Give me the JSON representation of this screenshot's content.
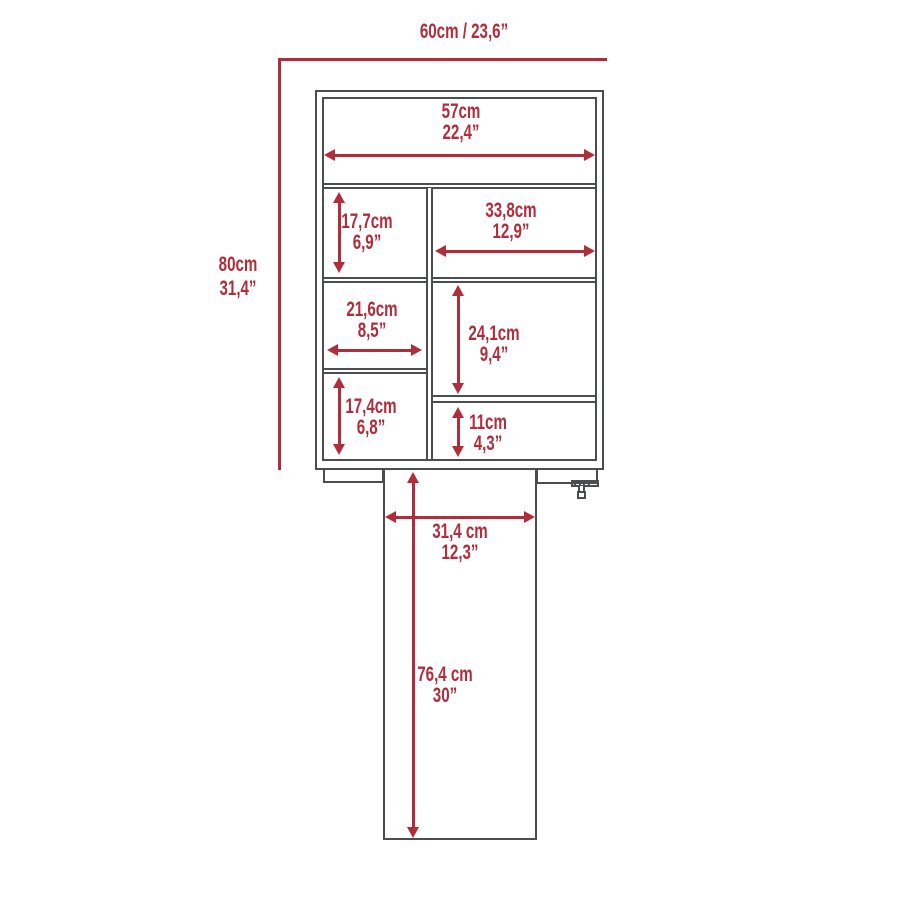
{
  "meta": {
    "diagram_type": "furniture-dimension-diagram",
    "background_color": "#ffffff",
    "accent_color": "#b22d3c",
    "line_color": "#4c4d4f"
  },
  "dimensions": {
    "overall_width": {
      "combined": "60cm / 23,6”"
    },
    "overall_height": {
      "cm": "80cm",
      "in": "31,4”"
    },
    "inner_width": {
      "cm": "57cm",
      "in": "22,4”"
    },
    "upper_left_height": {
      "cm": "17,7cm",
      "in": "6,9”"
    },
    "upper_right_width": {
      "cm": "33,8cm",
      "in": "12,9”"
    },
    "middle_left_width": {
      "cm": "21,6cm",
      "in": "8,5”"
    },
    "middle_right_height": {
      "cm": "24,1cm",
      "in": "9,4”"
    },
    "lower_left_height": {
      "cm": "17,4cm",
      "in": "6,8”"
    },
    "lower_right_height": {
      "cm": "11cm",
      "in": "4,3”"
    },
    "desk_width": {
      "cm": "31,4 cm",
      "in": "12,3”"
    },
    "desk_height": {
      "cm": "76,4 cm",
      "in": "30”"
    }
  }
}
